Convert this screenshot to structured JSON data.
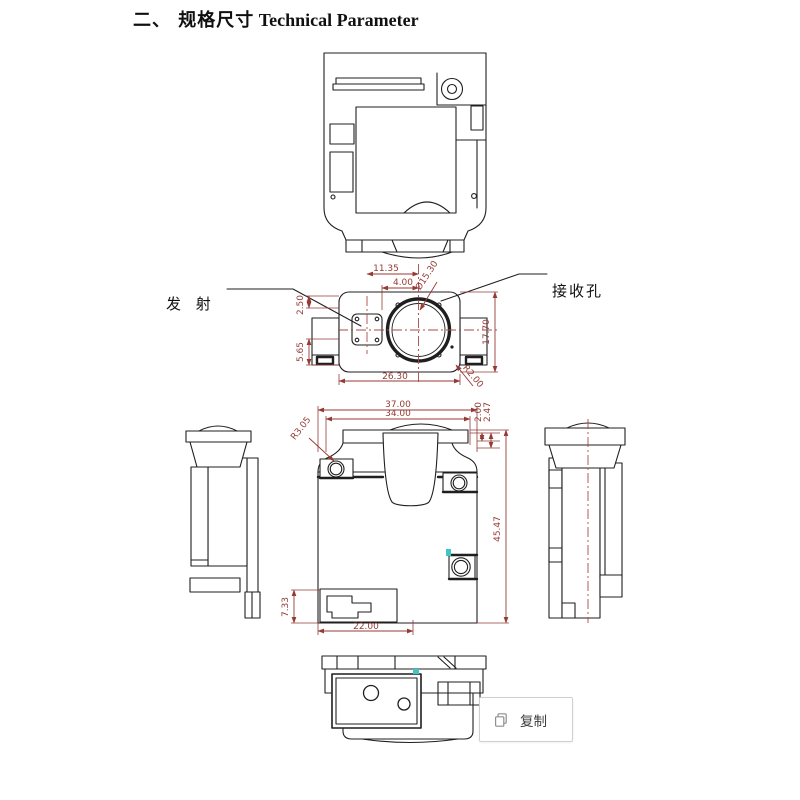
{
  "title": {
    "section": "二、 规格尺寸",
    "subtitle": "Technical Parameter"
  },
  "front_view": {
    "label_emitter": "发 射",
    "label_receiver": "接收孔",
    "dims": {
      "emitter_to_center": "11.35",
      "edge_to_center": "4.00",
      "receiver_diameter": "Ø15.30",
      "tab_offset": "2.50",
      "tab_height": "5.65",
      "body_height": "17.70",
      "body_width": "26.30",
      "corner_radius": "R2.00"
    }
  },
  "back_view": {
    "dims": {
      "overall_width": "37.00",
      "lens_width": "34.00",
      "top_offset_a": "2.00",
      "top_offset_b": "2.47",
      "fillet_radius": "R3.05",
      "overall_height": "45.47",
      "connector_height": "7.33",
      "connector_width": "22.00"
    }
  },
  "context_menu": {
    "copy_label": "复制"
  },
  "colors": {
    "dimension": "#953b36",
    "centerline": "#a84a44",
    "linework": "#1f1f1f",
    "highlight_teal": "#3ec6c6"
  }
}
